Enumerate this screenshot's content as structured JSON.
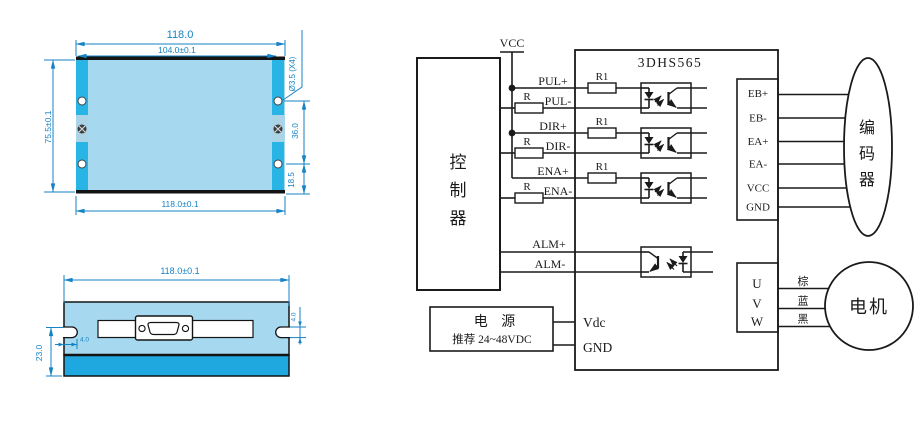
{
  "left": {
    "top_view": {
      "dim_top": "118.0",
      "dim_inner": "104.0±0.1",
      "dim_left": "75.5±0.1",
      "hole_note": "Ø3.5 (X4)",
      "dim_hole_spacing": "36.0",
      "dim_hole_offset": "18.5",
      "dim_bottom": "118.0±0.1"
    },
    "front_view": {
      "dim_top": "118.0±0.1",
      "dim_left": "23.0",
      "notch_depth": "4.0",
      "notch_height": "4.0"
    }
  },
  "schematic": {
    "chip_title": "3DHS565",
    "vcc": "VCC",
    "controller": [
      "控",
      "制",
      "器"
    ],
    "inputs": [
      {
        "plus": "PUL+",
        "minus": "PUL-",
        "r1": "R1",
        "r": "R"
      },
      {
        "plus": "DIR+",
        "minus": "DIR-",
        "r1": "R1",
        "r": "R"
      },
      {
        "plus": "ENA+",
        "minus": "ENA-",
        "r1": "R1",
        "r": "R"
      }
    ],
    "alarm": {
      "plus": "ALM+",
      "minus": "ALM-"
    },
    "encoder_pins": [
      "EB+",
      "EB-",
      "EA+",
      "EA-",
      "VCC",
      "GND"
    ],
    "encoder": [
      "编",
      "码",
      "器"
    ],
    "motor_pins": [
      "U",
      "V",
      "W"
    ],
    "wire_labels": [
      "棕",
      "蓝",
      "黑"
    ],
    "motor": "电机",
    "power_title": "电 源",
    "power_subtitle": "推荐 24~48VDC",
    "vdc": "Vdc",
    "gnd": "GND"
  },
  "colors": {
    "body_light": "#a6d9ef",
    "rail_cyan": "#29b4e6",
    "strip_blue": "#1fa7e0",
    "dim_blue": "#1583c5",
    "line_black": "#1a1a1a"
  }
}
